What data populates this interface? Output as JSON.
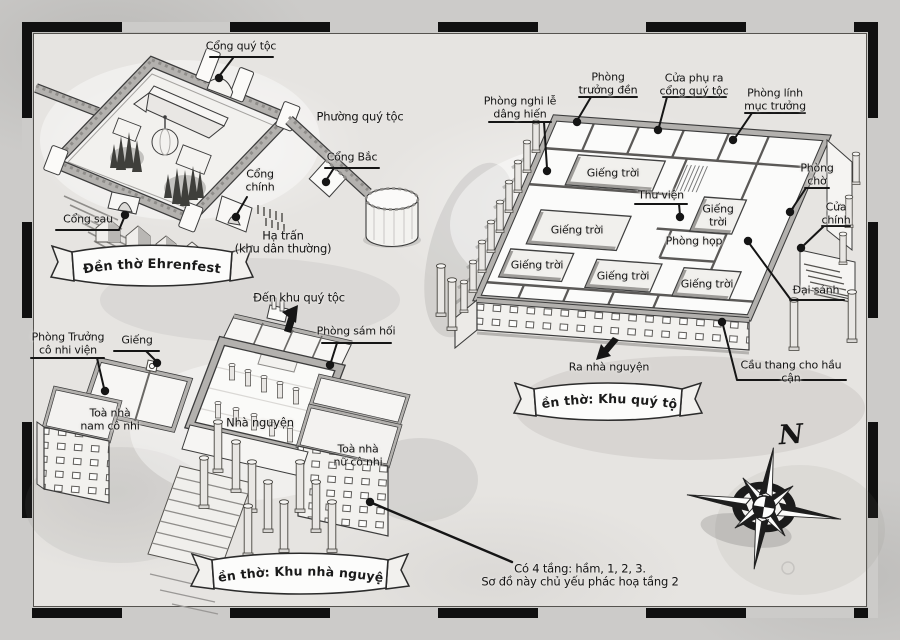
{
  "colors": {
    "paper": "#cccbc9",
    "map_bg": "#e6e4e1",
    "ink": "#141414",
    "wall_grey": "#b3b1ae"
  },
  "castle": {
    "banner": "Đền thờ Ehrenfest",
    "labels": {
      "noble_gate": "Cổng quý tộc",
      "noble_district": "Phường quý tộc",
      "north_gate": "Cổng Bắc",
      "main_gate": "Cổng\nchính",
      "back_gate": "Cổng sau",
      "lower_town": "Hạ trấn\n(khu dân thường)"
    }
  },
  "noble_quarter": {
    "banner": "Đền thờ: Khu quý tộc",
    "labels": {
      "offering_ritual_room": "Phòng nghi lễ\ndâng hiến",
      "temple_head_room": "Phòng\ntrưởng đền",
      "side_door_noble_gate": "Cửa phụ ra\ncổng quý tộc",
      "head_priest_guard_room": "Phòng lính\nmục trưởng",
      "waiting_room": "Phòng\nchờ",
      "main_door": "Cửa\nchính",
      "library": "Thư viện",
      "meeting_room": "Phòng họp",
      "great_hall": "Đại sảnh",
      "servant_stairs": "Cầu thang cho hầu cận",
      "to_chapel": "Ra nhà nguyện",
      "skylight": "Giếng trời",
      "skylight_2line": "Giếng\ntrời"
    }
  },
  "chapel_quarter": {
    "banner": "Đền thờ: Khu nhà nguyện",
    "labels": {
      "orphanage_director_room": "Phòng Trưởng\ncô nhi viện",
      "well": "Giếng",
      "boys_orphanage": "Toà nhà\nnam cô nhi",
      "chapel": "Nhà nguyện",
      "confession_room": "Phòng sám hối",
      "girls_orphanage": "Toà nhà\nnữ cô nhi",
      "to_noble_quarter": "Đến khu quý tộc"
    }
  },
  "note": "Có 4 tầng: hầm, 1, 2, 3.\nSơ đồ này chủ yếu phác hoạ tầng 2",
  "compass": {
    "north": "N"
  }
}
